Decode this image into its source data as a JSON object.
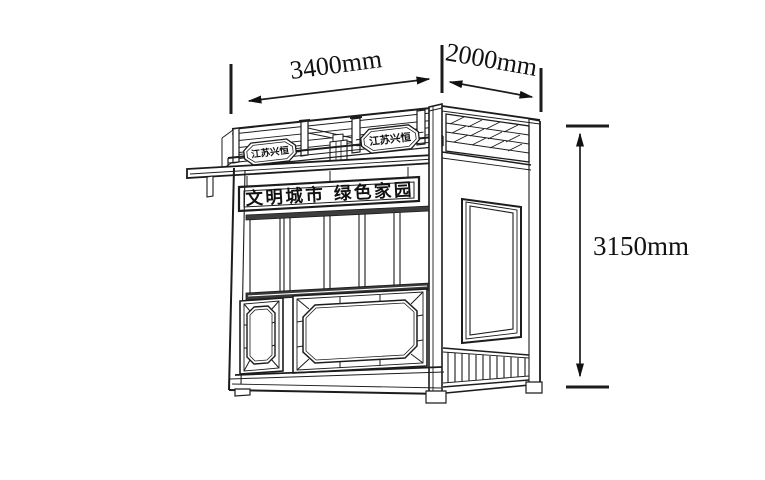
{
  "drawing": {
    "background": "#ffffff",
    "line_color": "#1c1c1c",
    "dark_band_color": "#3a3a3a"
  },
  "dimensions": {
    "width_label": "3400mm",
    "depth_label": "2000mm",
    "height_label": "3150mm"
  },
  "kiosk": {
    "banner_text": "文明城市 绿色家园",
    "left_plaque_text": "江苏兴恒",
    "right_plaque_text": "江苏兴恒"
  }
}
